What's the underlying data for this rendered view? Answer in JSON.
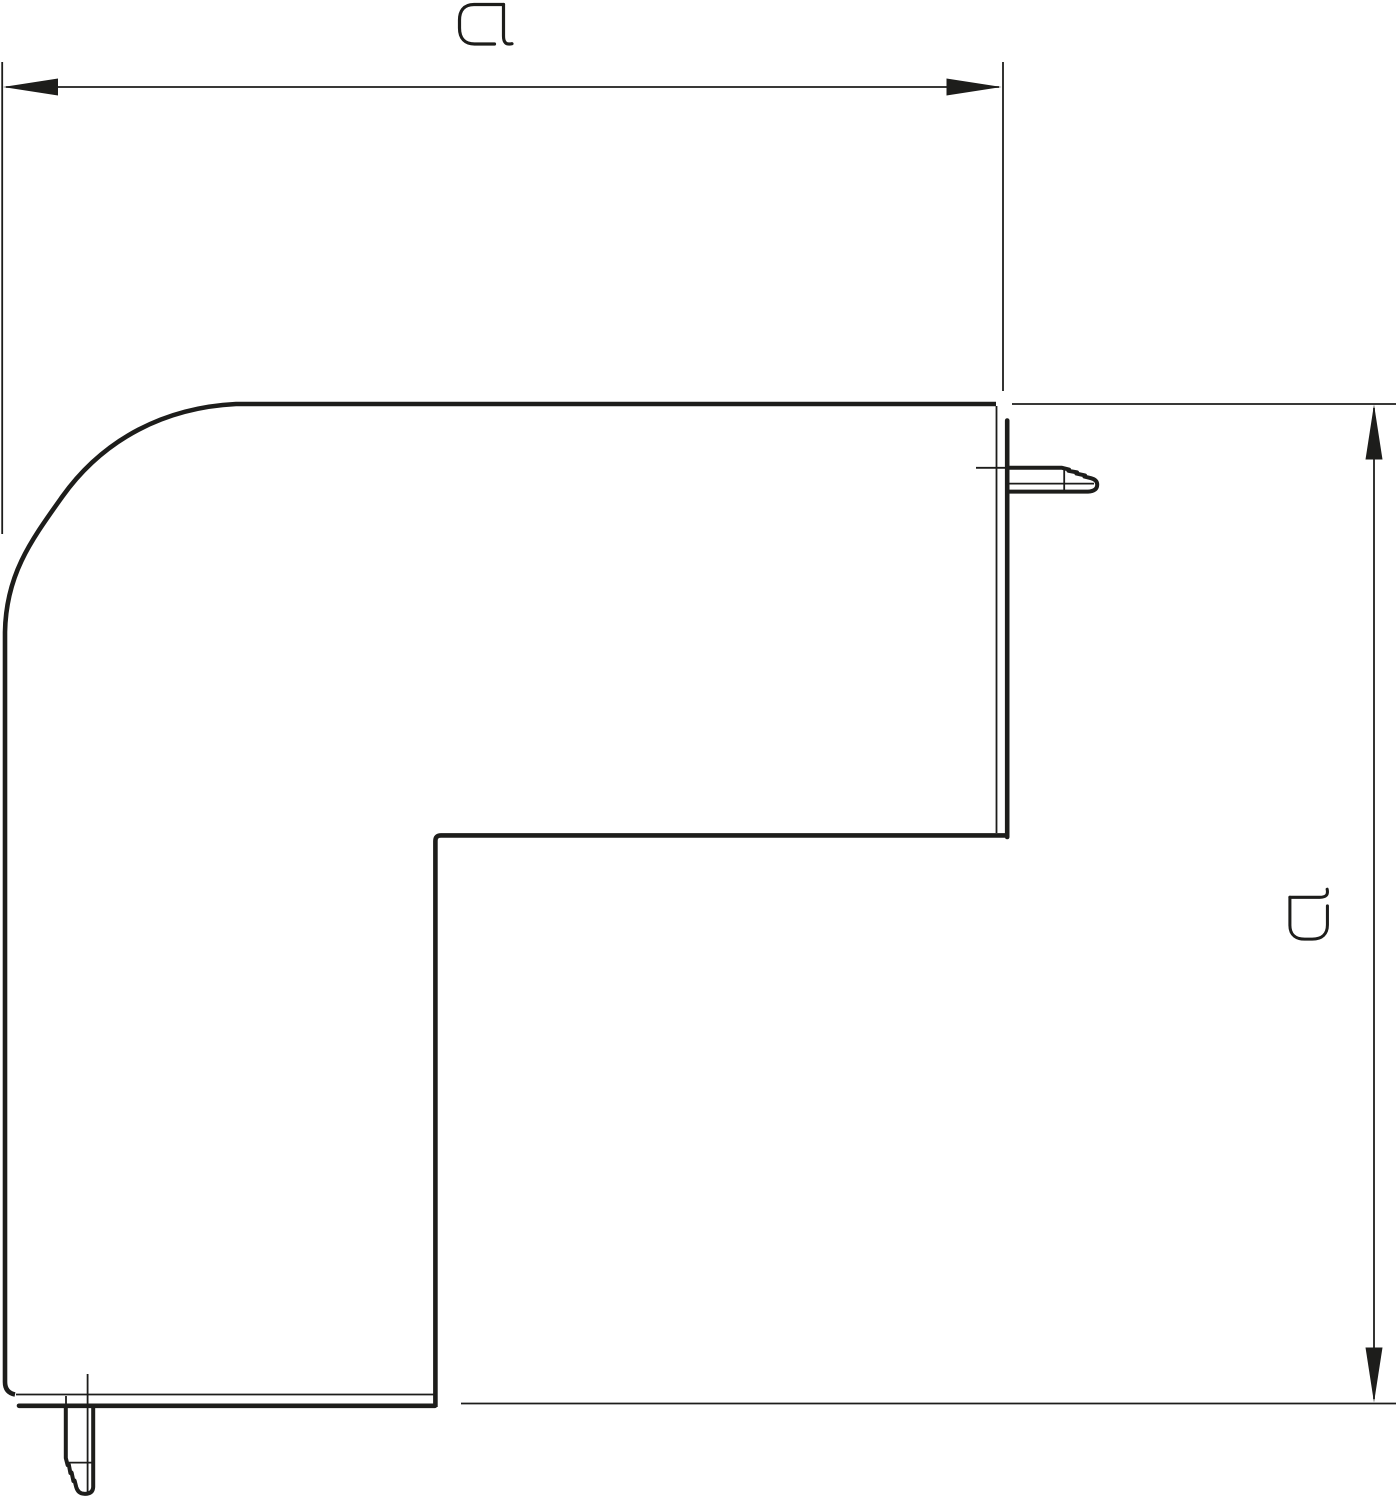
{
  "figure": {
    "kind": "technical-dimension-drawing",
    "subject": "L-shaped external corner profile with end caps and snap latches"
  },
  "dimensions": {
    "width": {
      "label": "a",
      "orientation": "horizontal"
    },
    "height": {
      "label": "a",
      "orientation": "vertical"
    }
  },
  "colors": {
    "line": "#1d1d1b",
    "background": "#ffffff"
  }
}
